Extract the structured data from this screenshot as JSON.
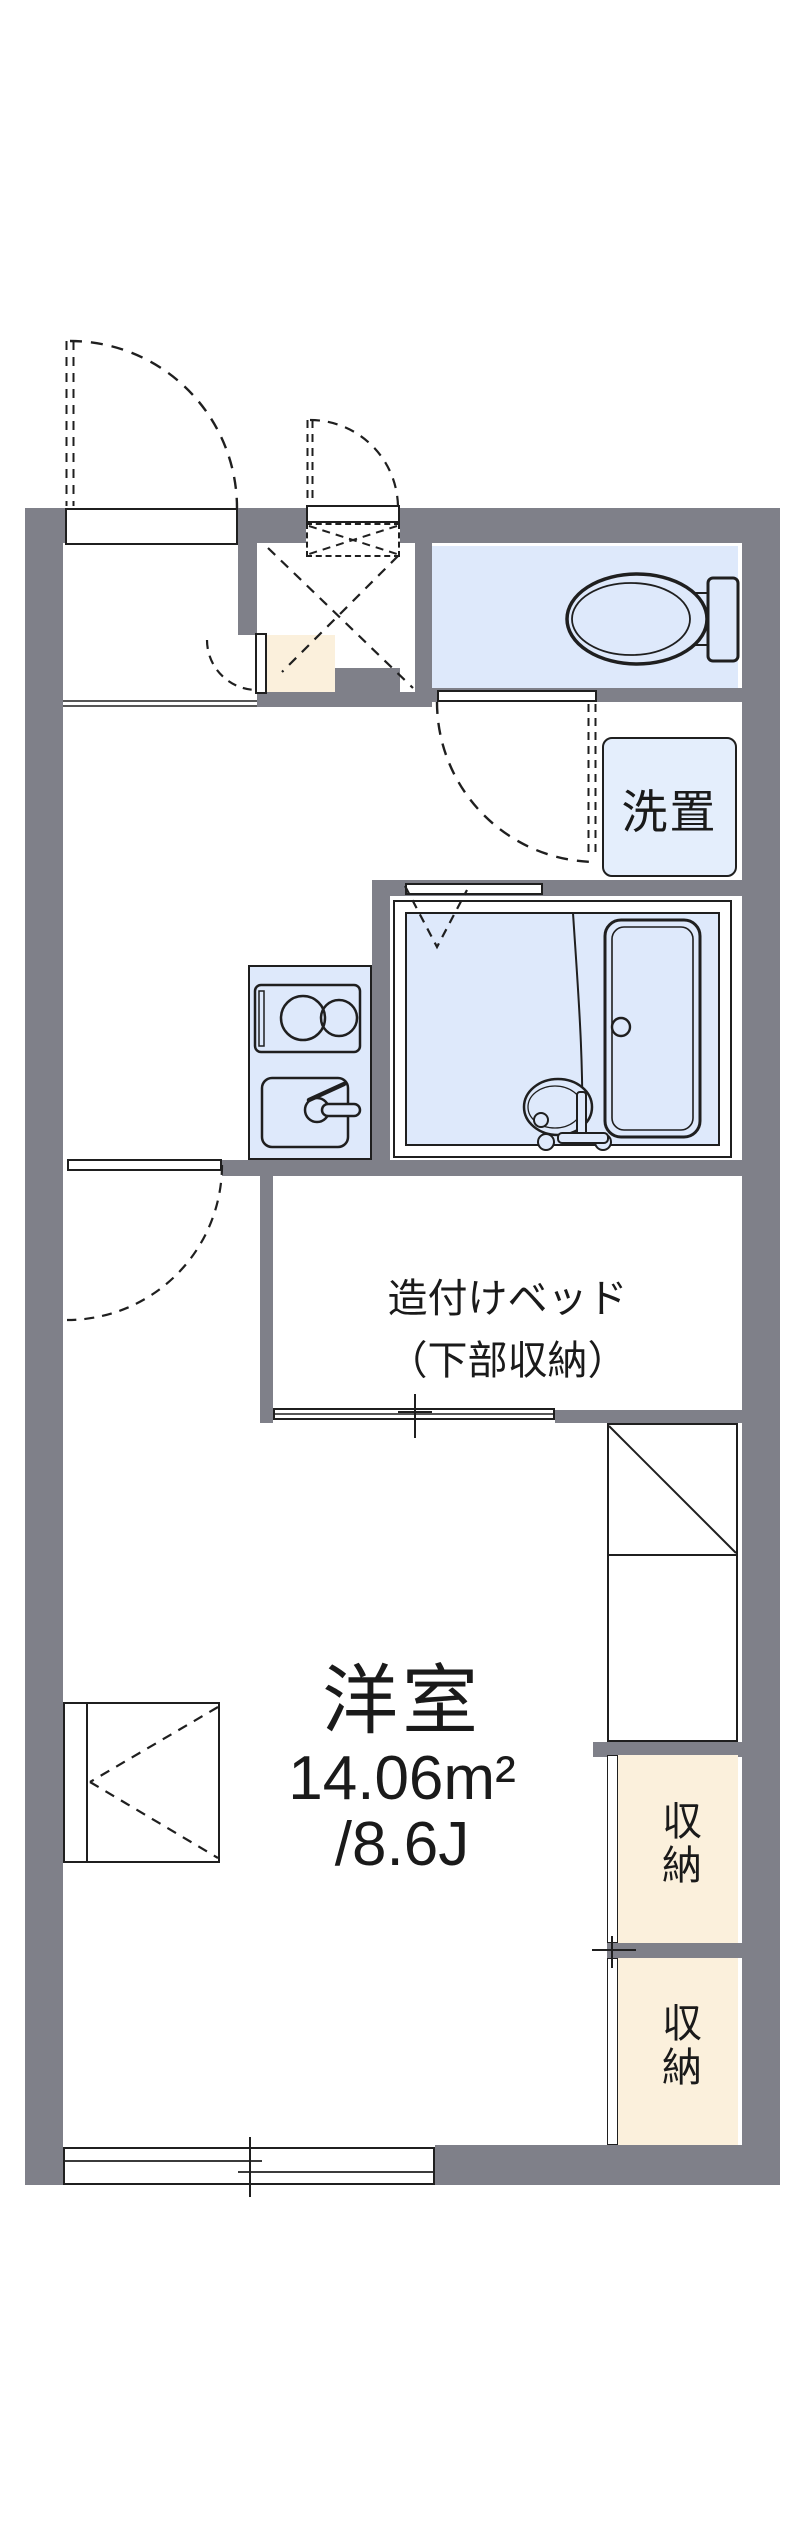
{
  "plan": {
    "labels": {
      "washer": "洗置",
      "bed_line1": "造付けベッド",
      "bed_line2": "（下部収納）",
      "room_name": "洋室",
      "room_area_m2": "14.06m²",
      "room_area_jo": "/8.6J",
      "storage_upper": "収納",
      "storage_lower": "収納"
    },
    "colors": {
      "wall_gray": "#7F8089",
      "water_area_blue": "#DEE9FB",
      "storage_beige": "#FBF0DC",
      "line_dark": "#1F1F1F"
    }
  }
}
